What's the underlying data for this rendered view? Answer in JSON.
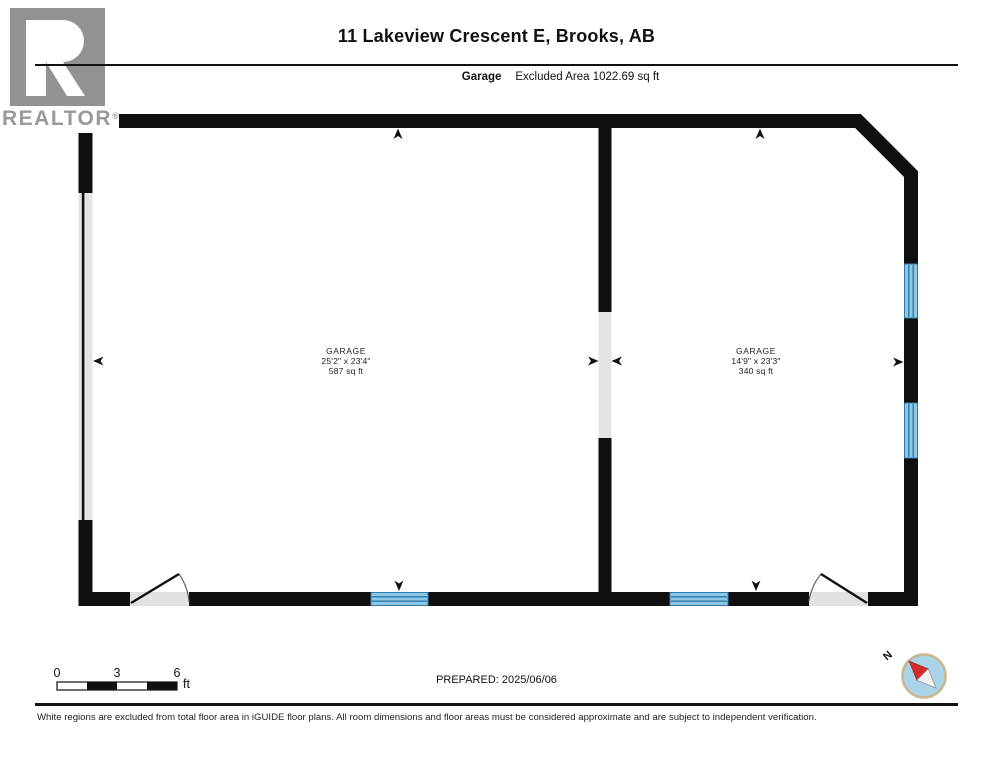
{
  "header": {
    "title": "11 Lakeview Crescent E, Brooks, AB",
    "floor_label": "Garage",
    "excluded_area": "Excluded Area 1022.69 sq ft",
    "logo_text": "REALTOR",
    "logo_reg": "®"
  },
  "rooms": [
    {
      "name": "GARAGE",
      "dimensions": "25'2\" x 23'4\"",
      "area": "587 sq ft"
    },
    {
      "name": "GARAGE",
      "dimensions": "14'9\" x 23'3\"",
      "area": "340 sq ft"
    }
  ],
  "scale_bar": {
    "labels": [
      "0",
      "3",
      "6"
    ],
    "unit": "ft"
  },
  "footer": {
    "prepared": "PREPARED: 2025/06/06",
    "compass_label": "N",
    "disclaimer": "White regions are excluded from total floor area in iGUIDE floor plans. All room dimensions and floor areas must be considered approximate and are subject to independent verification."
  },
  "colors": {
    "wall": "#0f0f0f",
    "excluded_region": "#e4e4e4",
    "window_fill": "#8cc7e5",
    "window_line": "#2f78a8",
    "logo_gray": "#929292",
    "compass_fill": "#aad2e8",
    "compass_ring": "#c7b793",
    "needle_red": "#d32b2b"
  }
}
